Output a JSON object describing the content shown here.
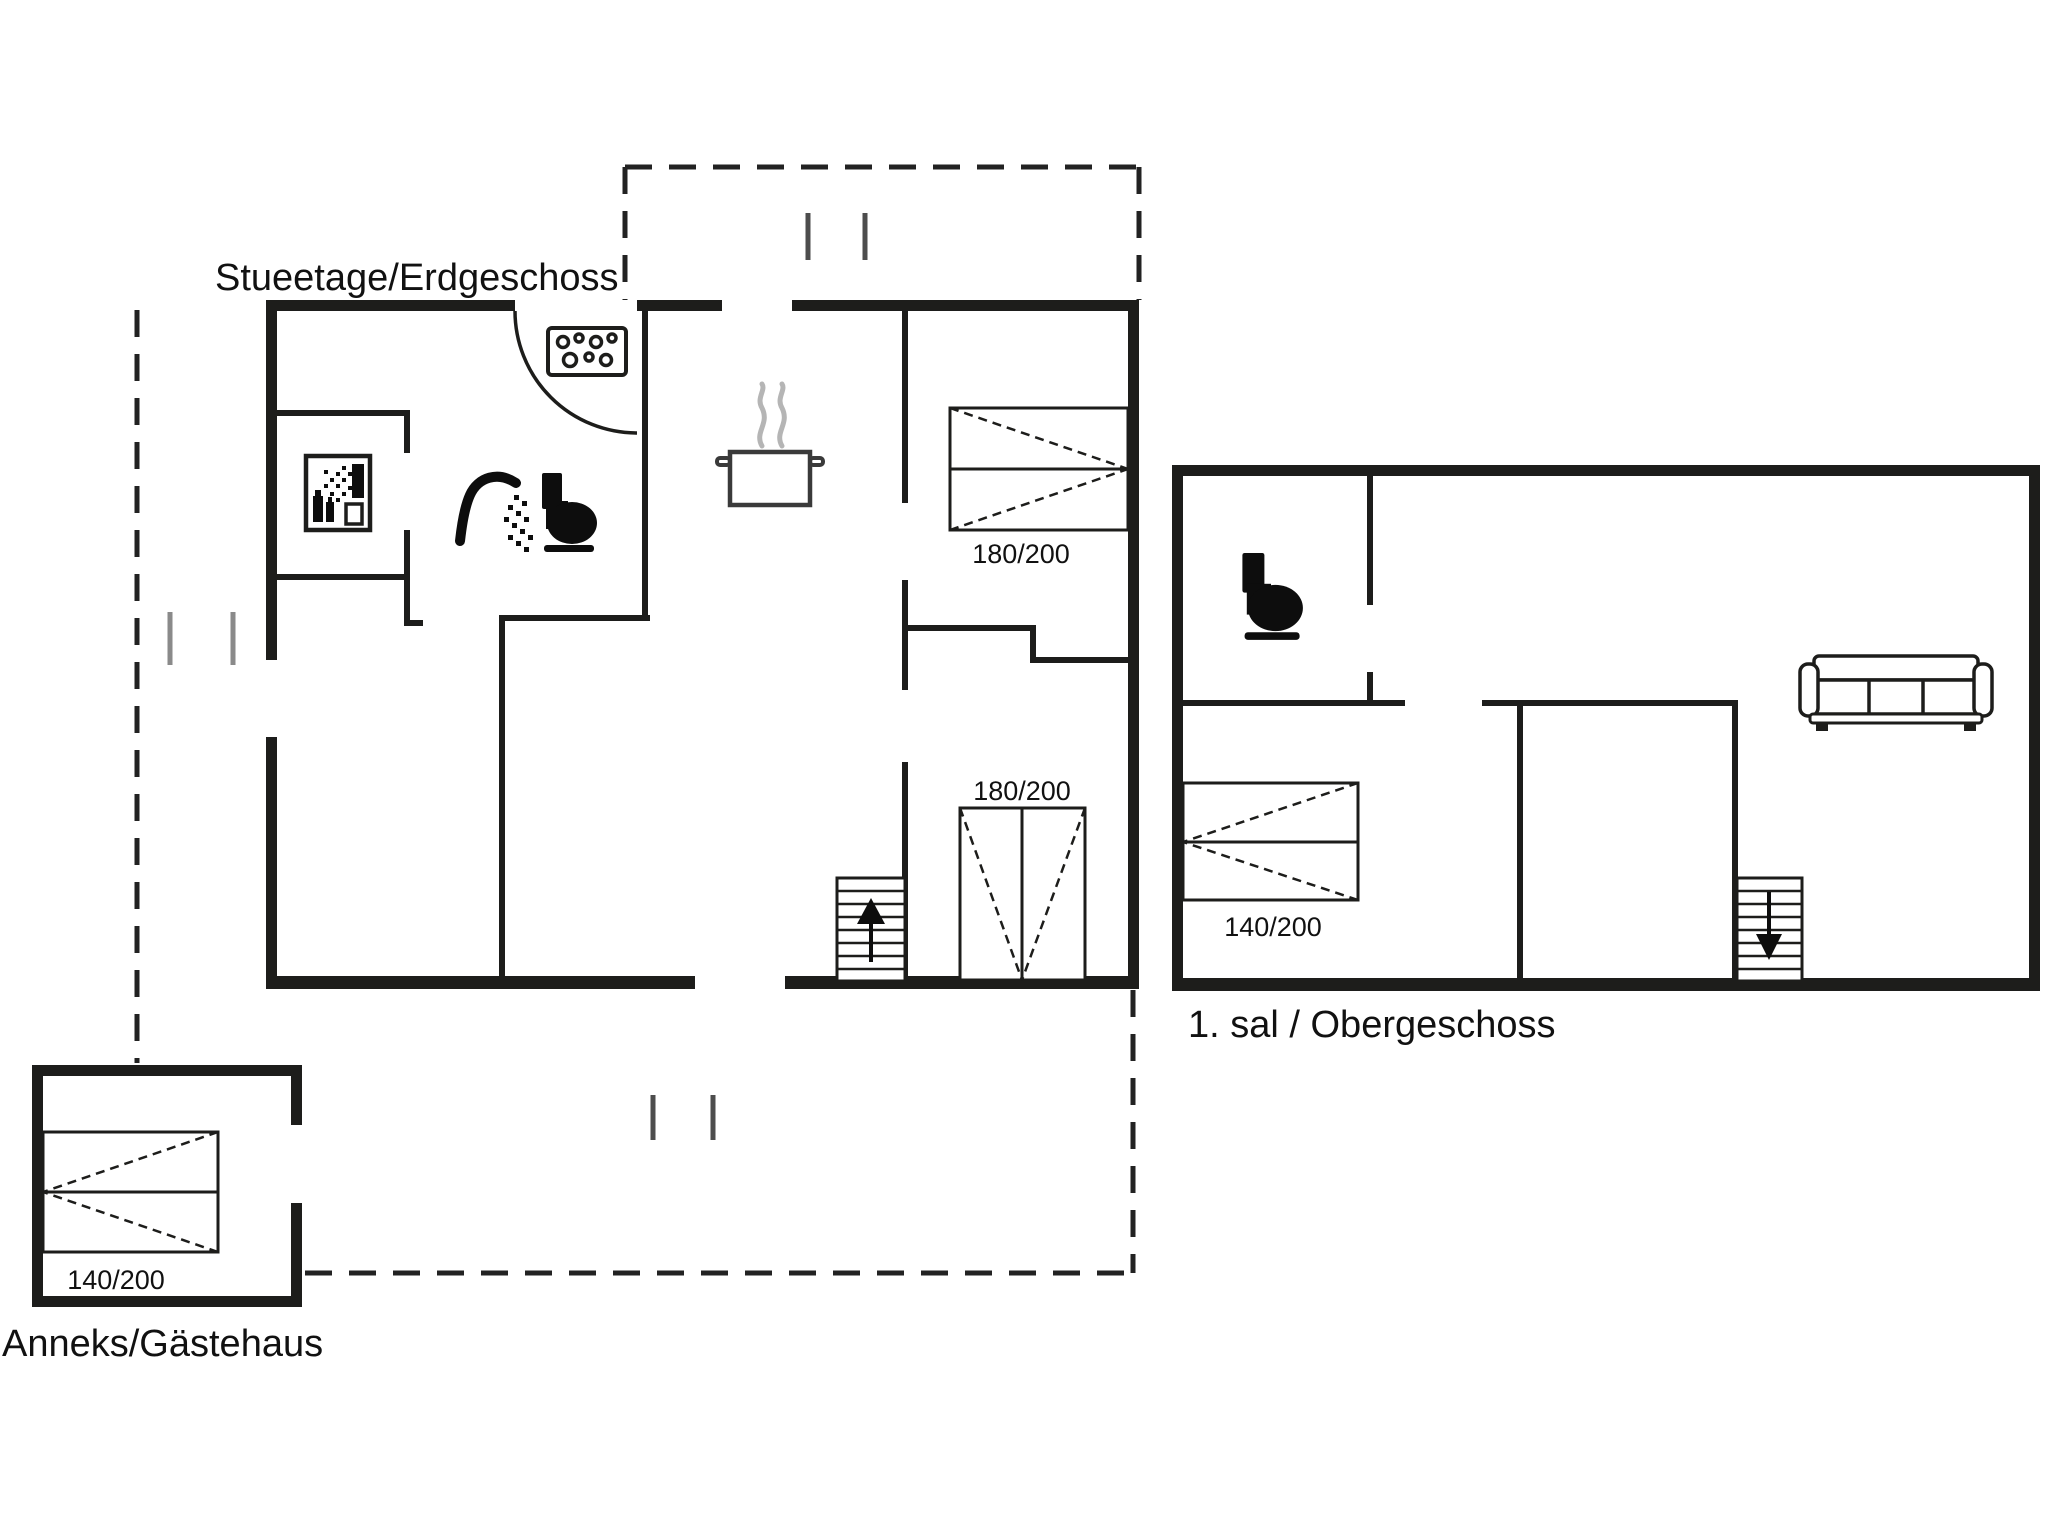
{
  "colors": {
    "background": "#ffffff",
    "wall": "#1d1d1b",
    "icon": "#0d0d0d",
    "steam": "#b5b5b5",
    "window_tick": "#4d4d4d",
    "carport_tick": "#8a8a8a"
  },
  "floors": {
    "ground": {
      "label": "Stueetage/Erdgeschoss",
      "beds": [
        {
          "label": "180/200"
        },
        {
          "label": "180/200"
        }
      ],
      "features": [
        "hob-icon",
        "cooking-pot-icon",
        "shower-icon",
        "toilet-icon",
        "washing-machine-icon",
        "stairs-up-icon",
        "door-swing-arc",
        "terrace-dashed-outline",
        "window-ticks"
      ]
    },
    "upper": {
      "label": "1. sal / Obergeschoss",
      "beds": [
        {
          "label": "140/200"
        }
      ],
      "features": [
        "toilet-icon",
        "sofa-icon",
        "stairs-down-icon"
      ]
    },
    "annex": {
      "label": "Anneks/Gästehaus",
      "beds": [
        {
          "label": "140/200"
        }
      ],
      "features": []
    }
  }
}
